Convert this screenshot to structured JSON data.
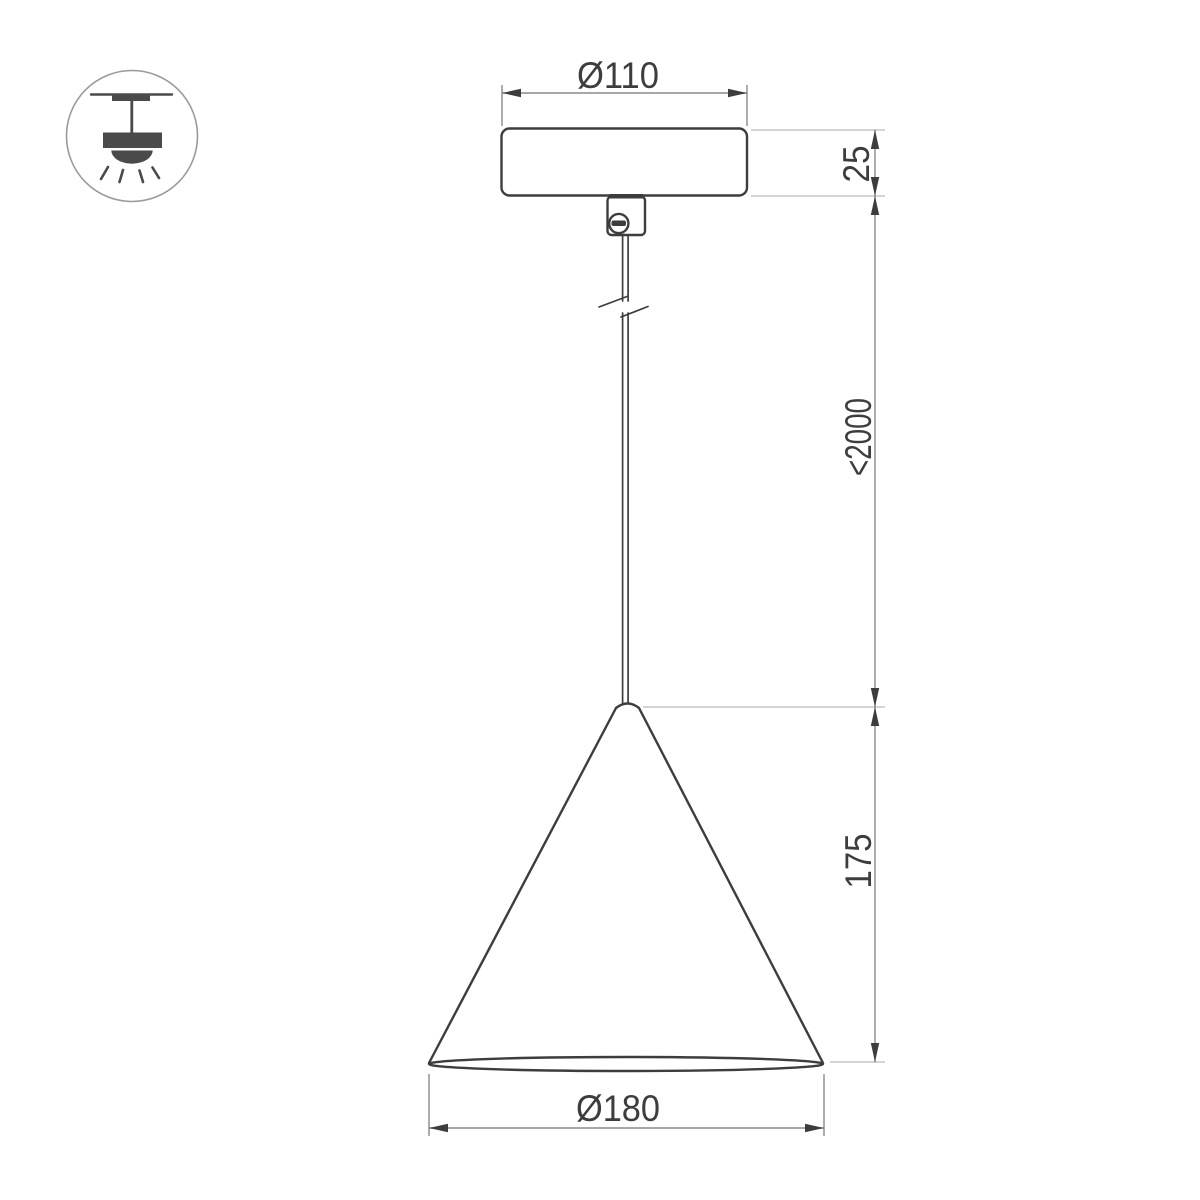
{
  "colors": {
    "background": "#ffffff",
    "object_line": "#3d3d3d",
    "dim_line": "#8a8a8a",
    "ext_line": "#c6c6c6",
    "text_color": "#3d3d3d",
    "icon_color": "#4a4a4a",
    "icon_ring": "#9a9a9a"
  },
  "drawing": {
    "type": "pendant-lamp-dimension-drawing",
    "labels": {
      "canopy_diameter": "Ø110",
      "canopy_height": "25",
      "suspension_length": "<2000",
      "shade_height": "175",
      "shade_diameter": "Ø180"
    }
  },
  "icon": {
    "name": "ceiling-pendant-light"
  }
}
